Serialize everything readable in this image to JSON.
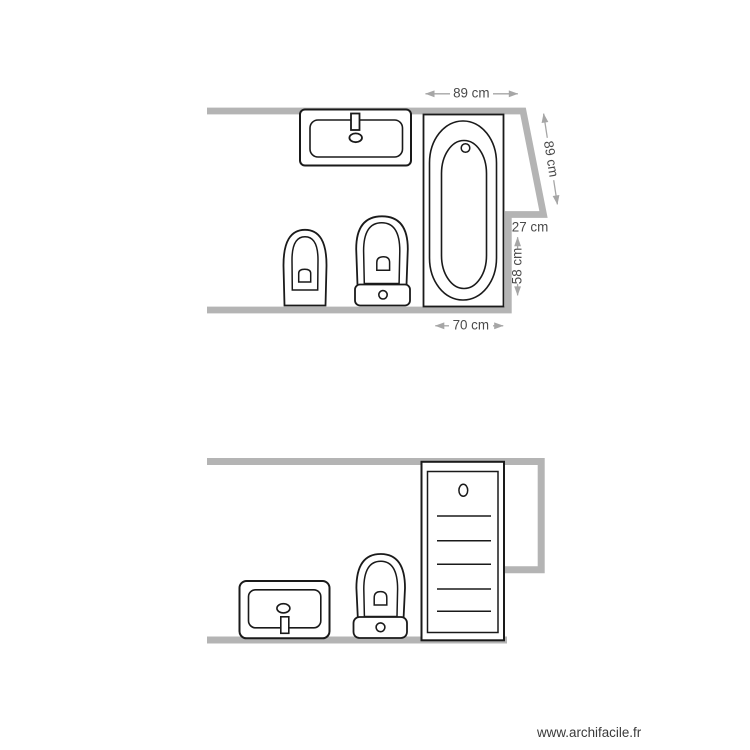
{
  "watermark": {
    "text": "www.archifacile.fr"
  },
  "colors": {
    "background": "#ffffff",
    "wall": "#b4b4b4",
    "fixture_outline": "#1a1a1a",
    "dimension_line": "#a6a6a6",
    "dimension_text": "#4a4a4a"
  },
  "rooms": {
    "top": {
      "title": "bathroom-plan-top-view",
      "fixtures": [
        "washbasin",
        "bidet",
        "toilet",
        "bathtub"
      ],
      "dims": {
        "top_width": {
          "label": "89 cm"
        },
        "slant_wall": {
          "label": "89 cm"
        },
        "recess_width": {
          "label": "27 cm"
        },
        "recess_height": {
          "label": "58 cm"
        },
        "tub_width": {
          "label": "70 cm"
        }
      }
    },
    "bottom": {
      "title": "bathroom-plan-bottom-view",
      "fixtures": [
        "washbasin",
        "toilet",
        "shower-column"
      ]
    }
  }
}
